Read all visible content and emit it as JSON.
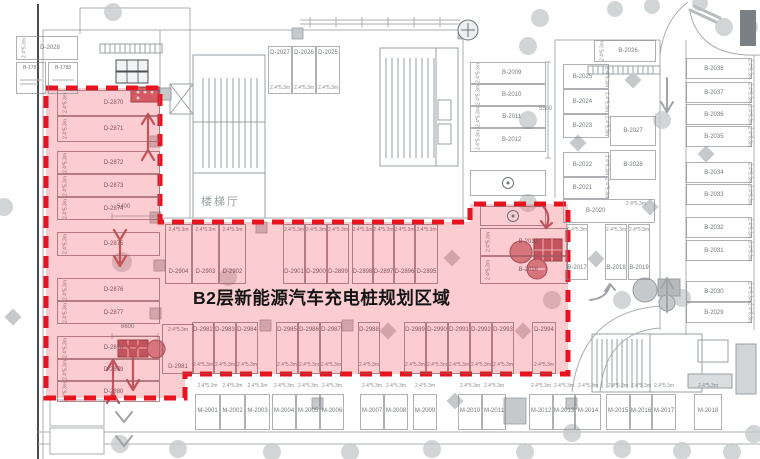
{
  "zone": {
    "title": "B2层新能源汽车充电桩规划区域",
    "accent_color": "#e7131f",
    "fill_color": "#ef4550"
  },
  "texts": {
    "stair_hall": "楼梯厅",
    "dim_spot": "2.4*5.3m",
    "dim_aisle_left_top": "5400",
    "dim_aisle_left_bottom": "6600",
    "dim_aisle_right": "5500"
  },
  "spots": {
    "left_column": [
      {
        "label": "D-2870",
        "x": 57,
        "y": 90,
        "w": 103,
        "h": 26
      },
      {
        "label": "D-2871",
        "x": 57,
        "y": 116,
        "w": 103,
        "h": 26
      },
      {
        "label": "D-2872",
        "x": 57,
        "y": 151,
        "w": 103,
        "h": 23
      },
      {
        "label": "D-2873",
        "x": 57,
        "y": 174,
        "w": 103,
        "h": 23
      },
      {
        "label": "D-2874",
        "x": 57,
        "y": 197,
        "w": 103,
        "h": 23
      },
      {
        "label": "D-2875",
        "x": 57,
        "y": 232,
        "w": 103,
        "h": 24
      },
      {
        "label": "D-2876",
        "x": 57,
        "y": 278,
        "w": 103,
        "h": 23
      },
      {
        "label": "D-2877",
        "x": 57,
        "y": 301,
        "w": 103,
        "h": 23
      },
      {
        "label": "D-2878",
        "x": 57,
        "y": 336,
        "w": 103,
        "h": 23
      },
      {
        "label": "D-2879",
        "x": 57,
        "y": 359,
        "w": 103,
        "h": 22
      },
      {
        "label": "D-2880",
        "x": 57,
        "y": 381,
        "w": 103,
        "h": 21
      }
    ],
    "top_left": [
      {
        "label": "D-2028",
        "x": 16,
        "y": 36,
        "w": 62,
        "h": 24
      }
    ],
    "top_left_rooms": [
      {
        "label": "B-1787",
        "x": 16,
        "y": 62,
        "w": 30,
        "h": 32
      },
      {
        "label": "B-1788",
        "x": 48,
        "y": 62,
        "w": 30,
        "h": 32
      }
    ],
    "top_middle": [
      {
        "label": "D-2027",
        "x": 268,
        "y": 46,
        "w": 24,
        "h": 48
      },
      {
        "label": "D-2026",
        "x": 292,
        "y": 46,
        "w": 24,
        "h": 48
      },
      {
        "label": "D-2025",
        "x": 316,
        "y": 46,
        "w": 24,
        "h": 48
      }
    ],
    "upper_row": [
      {
        "label": "D-2904",
        "x": 165,
        "y": 224,
        "w": 27,
        "h": 60
      },
      {
        "label": "D-2903",
        "x": 192,
        "y": 224,
        "w": 27,
        "h": 60
      },
      {
        "label": "D-2902",
        "x": 219,
        "y": 224,
        "w": 27,
        "h": 60
      },
      {
        "label": "D-2901",
        "x": 283,
        "y": 224,
        "w": 22,
        "h": 60
      },
      {
        "label": "D-2900",
        "x": 305,
        "y": 224,
        "w": 22,
        "h": 60
      },
      {
        "label": "D-2899",
        "x": 327,
        "y": 224,
        "w": 22,
        "h": 60
      },
      {
        "label": "D-2898",
        "x": 352,
        "y": 224,
        "w": 21,
        "h": 60
      },
      {
        "label": "D-2897",
        "x": 373,
        "y": 224,
        "w": 21,
        "h": 60
      },
      {
        "label": "D-2896",
        "x": 394,
        "y": 224,
        "w": 21,
        "h": 60
      },
      {
        "label": "D-2895",
        "x": 415,
        "y": 224,
        "w": 23,
        "h": 60
      }
    ],
    "inside_right": [
      {
        "label": "B-2015",
        "x": 480,
        "y": 228,
        "w": 88,
        "h": 28
      },
      {
        "label": "B-2016",
        "x": 480,
        "y": 256,
        "w": 88,
        "h": 28
      }
    ],
    "lower_head": [
      {
        "label": "D-2981",
        "x": 162,
        "y": 324,
        "w": 32,
        "h": 50
      }
    ],
    "lower_row": [
      {
        "label": "D-2982",
        "x": 192,
        "y": 322,
        "w": 22,
        "h": 52
      },
      {
        "label": "D-2983",
        "x": 214,
        "y": 322,
        "w": 22,
        "h": 52
      },
      {
        "label": "D-2984",
        "x": 236,
        "y": 322,
        "w": 22,
        "h": 52
      },
      {
        "label": "D-2985",
        "x": 276,
        "y": 322,
        "w": 22,
        "h": 52
      },
      {
        "label": "D-2986",
        "x": 298,
        "y": 322,
        "w": 22,
        "h": 52
      },
      {
        "label": "D-2987",
        "x": 320,
        "y": 322,
        "w": 22,
        "h": 52
      },
      {
        "label": "D-2988",
        "x": 358,
        "y": 322,
        "w": 22,
        "h": 52
      },
      {
        "label": "D-2989",
        "x": 404,
        "y": 322,
        "w": 22,
        "h": 52
      },
      {
        "label": "D-2990",
        "x": 426,
        "y": 322,
        "w": 22,
        "h": 52
      },
      {
        "label": "D-2991",
        "x": 448,
        "y": 322,
        "w": 22,
        "h": 52
      },
      {
        "label": "D-2992",
        "x": 470,
        "y": 322,
        "w": 22,
        "h": 52
      },
      {
        "label": "D-2993",
        "x": 492,
        "y": 322,
        "w": 22,
        "h": 52
      },
      {
        "label": "D-2994",
        "x": 532,
        "y": 322,
        "w": 24,
        "h": 52
      }
    ],
    "bottom_row": [
      {
        "label": "M-2001",
        "x": 195,
        "y": 394,
        "w": 25,
        "h": 36
      },
      {
        "label": "M-2002",
        "x": 220,
        "y": 394,
        "w": 25,
        "h": 36
      },
      {
        "label": "M-2003",
        "x": 245,
        "y": 394,
        "w": 25,
        "h": 36
      },
      {
        "label": "M-2004",
        "x": 272,
        "y": 394,
        "w": 24,
        "h": 36
      },
      {
        "label": "M-2005",
        "x": 296,
        "y": 394,
        "w": 24,
        "h": 36
      },
      {
        "label": "M-2006",
        "x": 320,
        "y": 394,
        "w": 24,
        "h": 36
      },
      {
        "label": "M-2007",
        "x": 360,
        "y": 394,
        "w": 24,
        "h": 36
      },
      {
        "label": "M-2008",
        "x": 384,
        "y": 394,
        "w": 24,
        "h": 36
      },
      {
        "label": "M-2009",
        "x": 413,
        "y": 394,
        "w": 24,
        "h": 36
      },
      {
        "label": "M-2010",
        "x": 458,
        "y": 394,
        "w": 24,
        "h": 36
      },
      {
        "label": "M-2011",
        "x": 482,
        "y": 394,
        "w": 24,
        "h": 36
      },
      {
        "label": "M-2012",
        "x": 529,
        "y": 394,
        "w": 24,
        "h": 36
      },
      {
        "label": "M-2013",
        "x": 553,
        "y": 394,
        "w": 22,
        "h": 36
      },
      {
        "label": "M-2014",
        "x": 575,
        "y": 394,
        "w": 26,
        "h": 36
      },
      {
        "label": "M-2015",
        "x": 606,
        "y": 394,
        "w": 24,
        "h": 36
      },
      {
        "label": "M-2016",
        "x": 630,
        "y": 394,
        "w": 22,
        "h": 36
      },
      {
        "label": "M-2017",
        "x": 652,
        "y": 394,
        "w": 24,
        "h": 36
      },
      {
        "label": "M-2018",
        "x": 694,
        "y": 394,
        "w": 28,
        "h": 36
      }
    ],
    "right_col_a": [
      {
        "label": "B-2009",
        "x": 470,
        "y": 62,
        "w": 76,
        "h": 22
      },
      {
        "label": "B-2010",
        "x": 470,
        "y": 84,
        "w": 76,
        "h": 22
      },
      {
        "label": "B-2011",
        "x": 470,
        "y": 106,
        "w": 76,
        "h": 22
      },
      {
        "label": "B-2012",
        "x": 470,
        "y": 128,
        "w": 76,
        "h": 24
      }
    ],
    "sign_spots_gray": [
      {
        "x": 470,
        "y": 170,
        "w": 76,
        "h": 26
      }
    ],
    "sign_spots_red": [
      {
        "x": 480,
        "y": 206,
        "w": 66,
        "h": 20
      }
    ],
    "right_col_b": [
      {
        "label": "B-2025",
        "x": 563,
        "y": 64,
        "w": 46,
        "h": 25
      },
      {
        "label": "B-2024",
        "x": 563,
        "y": 89,
        "w": 46,
        "h": 25
      },
      {
        "label": "B-2023",
        "x": 563,
        "y": 114,
        "w": 46,
        "h": 24
      },
      {
        "label": "B-2022",
        "x": 563,
        "y": 152,
        "w": 46,
        "h": 25
      },
      {
        "label": "B-2021",
        "x": 563,
        "y": 177,
        "w": 46,
        "h": 22
      }
    ],
    "b2020_row": [
      {
        "label": "B-2020",
        "x": 563,
        "y": 199,
        "w": 92,
        "h": 24
      }
    ],
    "right_col_c_top": [
      {
        "label": "B-2026",
        "x": 594,
        "y": 40,
        "w": 62,
        "h": 22
      }
    ],
    "right_col_c": [
      {
        "label": "B-2027",
        "x": 610,
        "y": 116,
        "w": 46,
        "h": 30
      },
      {
        "label": "B-2028",
        "x": 610,
        "y": 150,
        "w": 46,
        "h": 30
      }
    ],
    "right_verticals": [
      {
        "label": "B-2017",
        "x": 566,
        "y": 224,
        "w": 22,
        "h": 56
      },
      {
        "label": "B-2018",
        "x": 605,
        "y": 224,
        "w": 22,
        "h": 56
      },
      {
        "label": "B-2019",
        "x": 628,
        "y": 224,
        "w": 22,
        "h": 56
      }
    ],
    "far_right": [
      {
        "label": "B-2038",
        "x": 686,
        "y": 58,
        "w": 66,
        "h": 21
      },
      {
        "label": "B-2037",
        "x": 686,
        "y": 82,
        "w": 66,
        "h": 21
      },
      {
        "label": "B-2036",
        "x": 686,
        "y": 104,
        "w": 66,
        "h": 21
      },
      {
        "label": "B-2035",
        "x": 686,
        "y": 126,
        "w": 66,
        "h": 21
      },
      {
        "label": "B-2034",
        "x": 686,
        "y": 162,
        "w": 66,
        "h": 21
      },
      {
        "label": "B-2033",
        "x": 686,
        "y": 184,
        "w": 66,
        "h": 21
      },
      {
        "label": "B-2032",
        "x": 686,
        "y": 217,
        "w": 66,
        "h": 21
      },
      {
        "label": "B-2031",
        "x": 686,
        "y": 240,
        "w": 66,
        "h": 21
      },
      {
        "label": "B-2030",
        "x": 686,
        "y": 281,
        "w": 66,
        "h": 21
      },
      {
        "label": "B-2029",
        "x": 686,
        "y": 302,
        "w": 66,
        "h": 21
      }
    ]
  }
}
